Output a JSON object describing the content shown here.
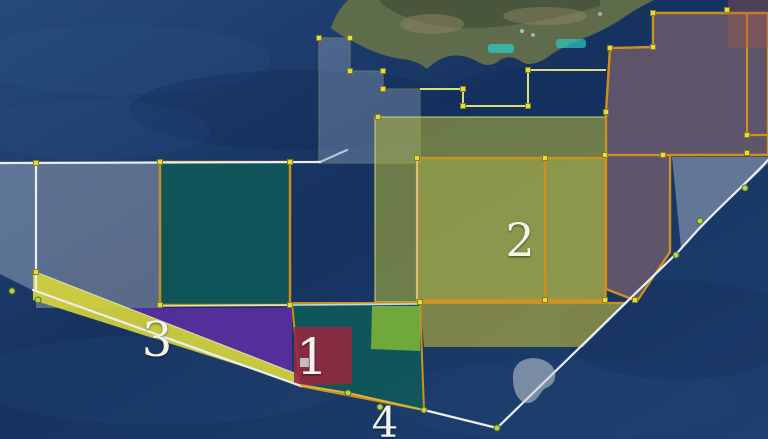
{
  "map": {
    "kind": "satellite-map-with-license-blocks",
    "labels": [
      {
        "name": "block-1",
        "text": "1"
      },
      {
        "name": "block-2",
        "text": "2"
      },
      {
        "name": "block-3",
        "text": "3"
      },
      {
        "name": "block-4",
        "text": "4"
      }
    ],
    "markers": {
      "vertex": "yellow-square-edit-handle",
      "boundary_point": "green-dot"
    },
    "colors": {
      "sea": "#1c3a6b",
      "island_land": "#5f6c4b",
      "border_orange": "#cf8f1c",
      "boundary_white": "#e9eef4",
      "step_line_light": "#d6e07a",
      "vertex_yellow": "#e4de3c",
      "dot_green": "#b6d44e",
      "block_teal": "#0e5c58",
      "block_yellow_outer": "#a9ad3c",
      "block_yellow_inner": "#b2b63c",
      "block_olive_strip": "#a3a341",
      "block_green": "#7db437",
      "block_maroon": "#932940",
      "block_purple": "#5b2fa0",
      "block_mauve": "#6f5c6d",
      "block_gray_left": "#8a94a6",
      "block_gray_coast": "#6d7f9d",
      "light_triangle": "#93a2b8",
      "red_overlay": "#a85a50",
      "wedge_yellow": "#d4d43b",
      "city_cyan": "#2fc4bd"
    }
  }
}
